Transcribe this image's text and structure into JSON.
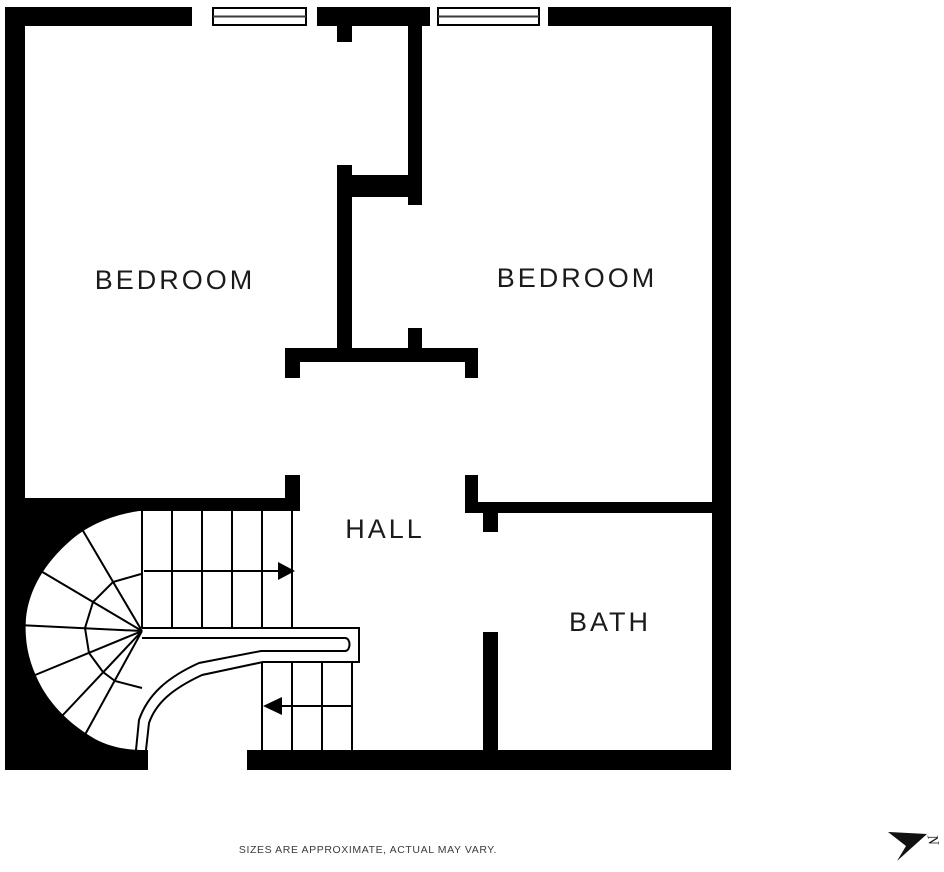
{
  "plan": {
    "rooms": [
      {
        "name": "bedroom-left",
        "label": "BEDROOM"
      },
      {
        "name": "bedroom-right",
        "label": "BEDROOM"
      },
      {
        "name": "hall",
        "label": "HALL"
      },
      {
        "name": "bath",
        "label": "BATH"
      }
    ],
    "colors": {
      "wall": "#000000",
      "background": "#ffffff",
      "label_text": "#1b1b1b",
      "footer_text": "#3b3b3b"
    }
  },
  "compass": {
    "north_label": "N"
  },
  "footer": {
    "disclaimer": "SIZES ARE APPROXIMATE, ACTUAL MAY VARY."
  }
}
